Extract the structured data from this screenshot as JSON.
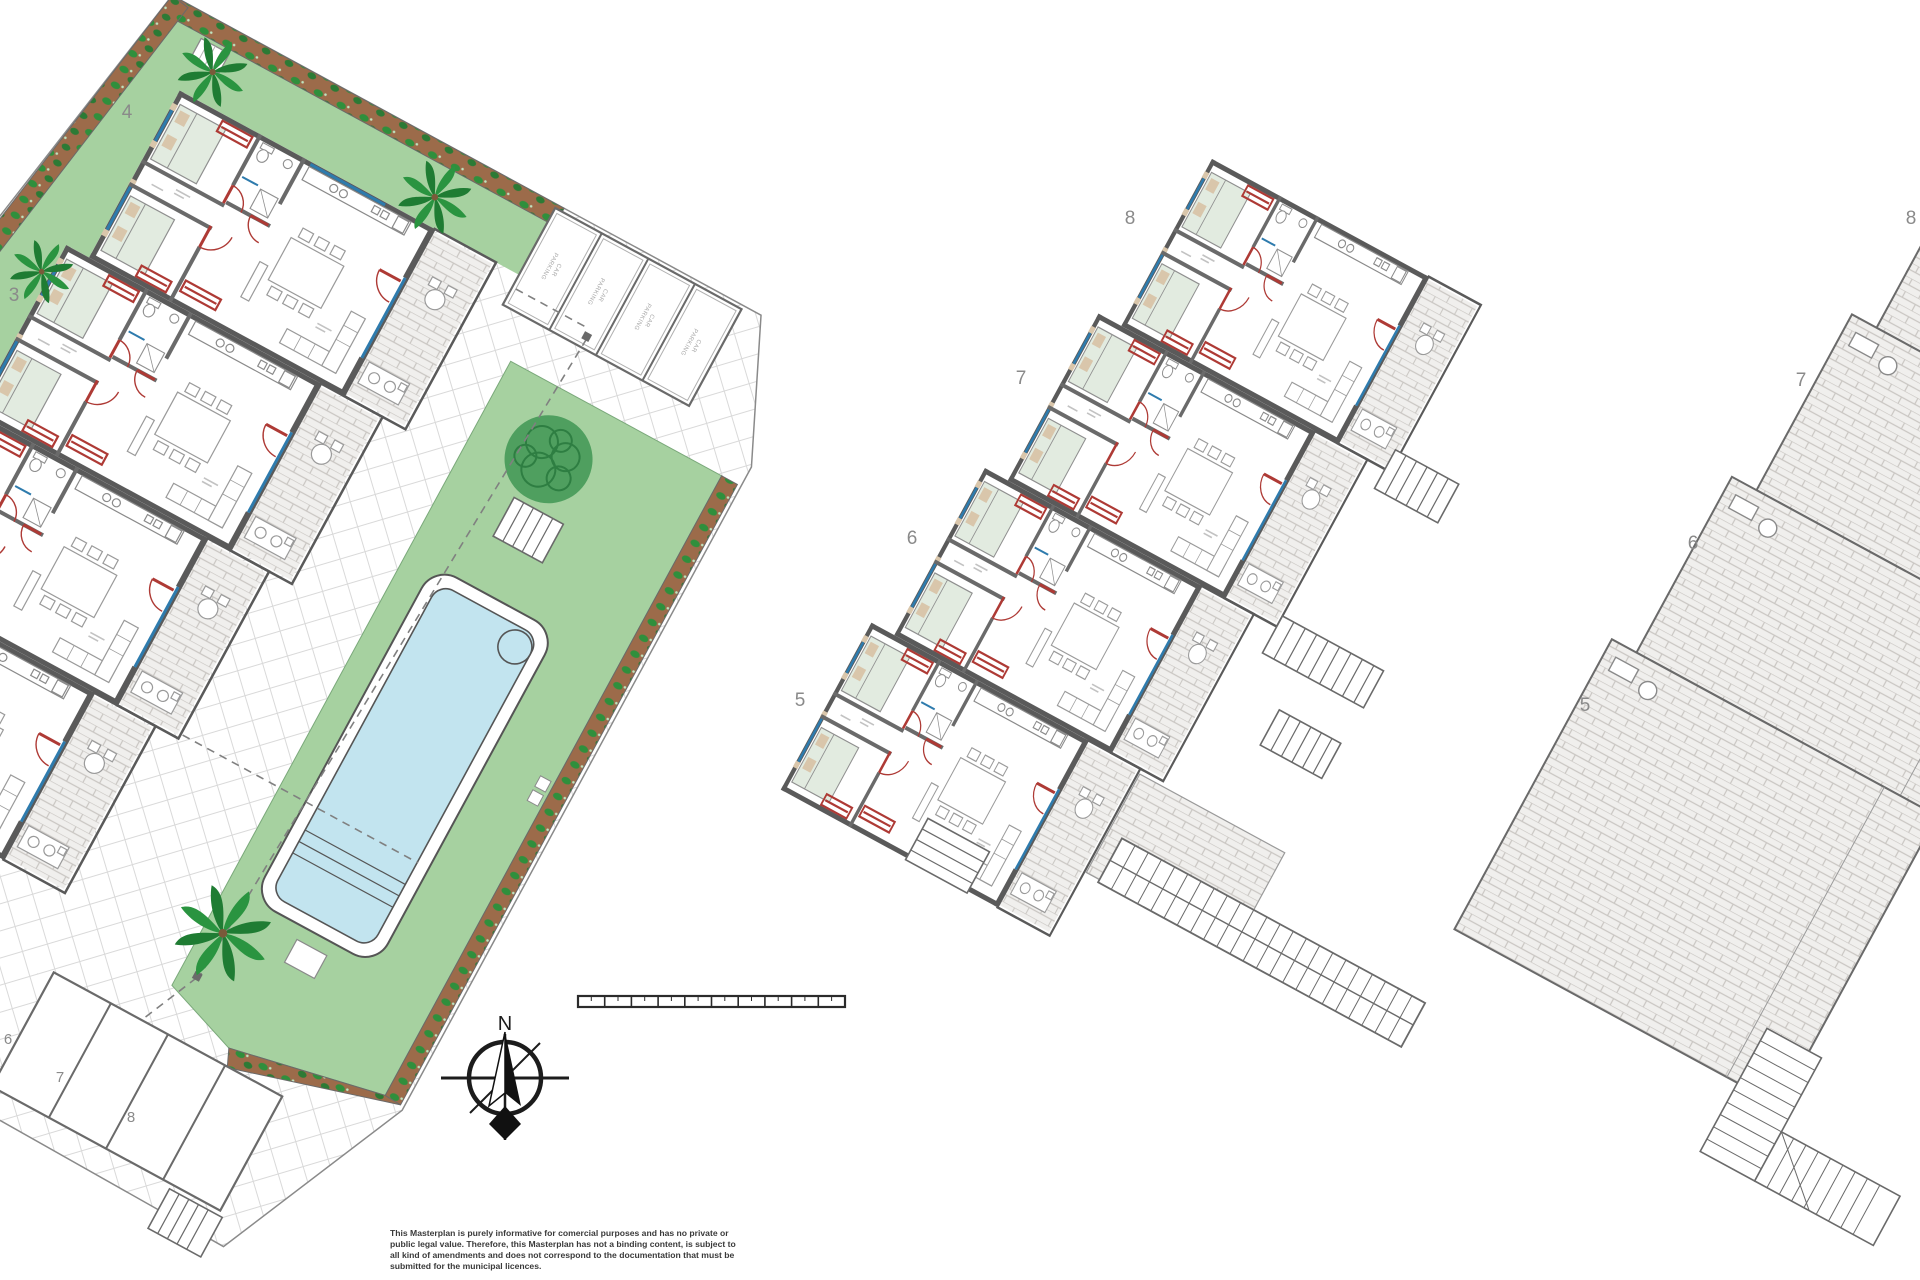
{
  "page": {
    "background": "#ffffff",
    "drawing_type": "residential masterplan floor plan"
  },
  "colors": {
    "wall_gray": "#5a5a5a",
    "door_red": "#ae3a35",
    "window_blue": "#2e7bad",
    "lawn_green": "#a6d1a0",
    "hedge_brown": "#9c6b4a",
    "hedge_leaf_green": "#2f8f3c",
    "pool_water_blue": "#c2e4ef",
    "palm_green": "#2a9440",
    "paving_grout": "#d9d9d9",
    "brick_line": "#c9c6c2",
    "label_gray": "#8a8a8a",
    "bed_green": "#e2ebe0",
    "pillow_tan": "#d9c6ab"
  },
  "left_complex": {
    "plot_labels": [
      "4",
      "3"
    ],
    "parking_labels": [
      "6",
      "7",
      "8"
    ],
    "stall_text": {
      "line1": "CAR",
      "line2": "PARKING"
    }
  },
  "middle_building": {
    "unit_labels": [
      "8",
      "7",
      "6",
      "5"
    ]
  },
  "right_building": {
    "unit_labels": [
      "8",
      "7",
      "6",
      "5"
    ]
  },
  "compass": {
    "north_label": "N"
  },
  "disclaimer": {
    "lines": [
      "This Masterplan is purely informative for comercial purposes and has no private or",
      "public legal value. Therefore, this Masterplan has not a binding content, is subject to",
      "all kind of amendments and does not correspond to the documentation that must be",
      "submitted for the municipal licences."
    ]
  }
}
